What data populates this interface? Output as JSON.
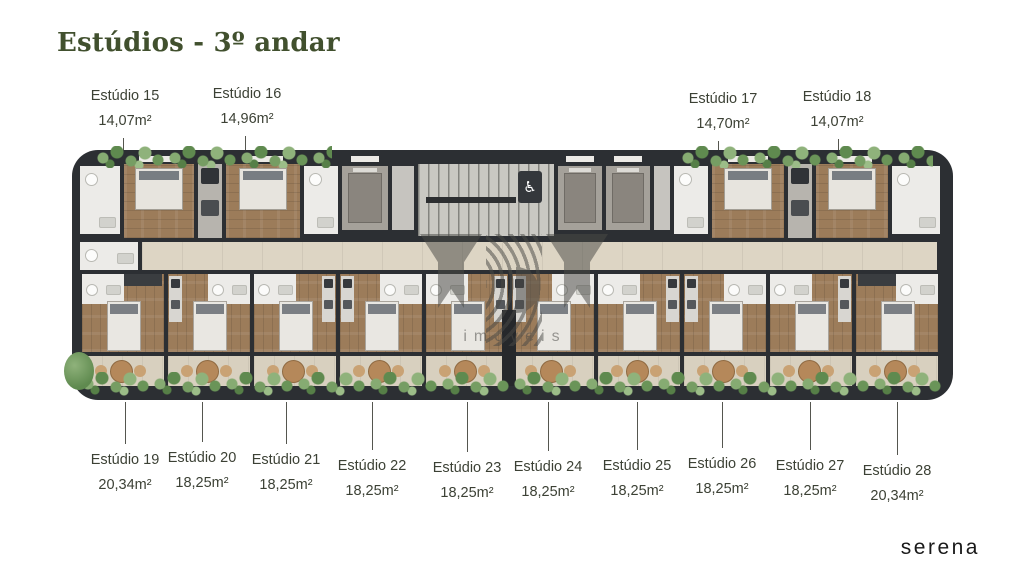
{
  "page": {
    "title": "Estúdios - 3º andar",
    "brand": "serena"
  },
  "watermark": {
    "letters": "MBM",
    "subtext": "imóveis"
  },
  "plan": {
    "accessibility_glyph": "♿",
    "units_top": [
      {
        "name": "Estúdio 15",
        "area": "14,07m²"
      },
      {
        "name": "Estúdio 16",
        "area": "14,96m²"
      },
      {
        "name": "Estúdio 17",
        "area": "14,70m²"
      },
      {
        "name": "Estúdio 18",
        "area": "14,07m²"
      }
    ],
    "units_bottom": [
      {
        "name": "Estúdio 19",
        "area": "20,34m²"
      },
      {
        "name": "Estúdio 20",
        "area": "18,25m²"
      },
      {
        "name": "Estúdio 21",
        "area": "18,25m²"
      },
      {
        "name": "Estúdio 22",
        "area": "18,25m²"
      },
      {
        "name": "Estúdio 23",
        "area": "18,25m²"
      },
      {
        "name": "Estúdio 24",
        "area": "18,25m²"
      },
      {
        "name": "Estúdio 25",
        "area": "18,25m²"
      },
      {
        "name": "Estúdio 26",
        "area": "18,25m²"
      },
      {
        "name": "Estúdio 27",
        "area": "18,25m²"
      },
      {
        "name": "Estúdio 28",
        "area": "20,34m²"
      }
    ]
  },
  "colors": {
    "title_green": "#41502e",
    "label_text": "#3c4135",
    "building_dark": "#2c2f33",
    "wood_floor": "#9c7c5a",
    "corridor_tile": "#ddd5c4",
    "greenery": "#6f9a5c",
    "watermark_gray": "#4a4a46",
    "brand_black": "#191919"
  }
}
